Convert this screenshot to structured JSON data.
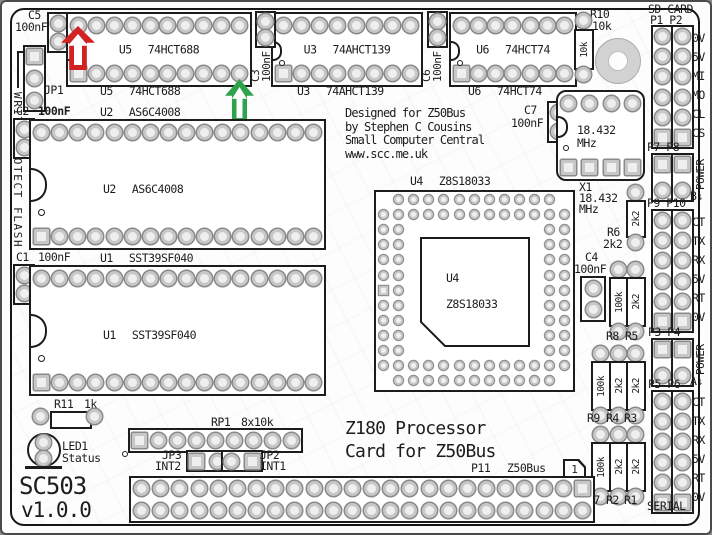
{
  "board": {
    "name": "SC503",
    "version": "v1.0.0",
    "title_line1": "Z180 Processor",
    "title_line2": "Card for Z50Bus",
    "credits": [
      "Designed for Z50Bus",
      "by Stephen C Cousins",
      "Small Computer Central",
      "www.scc.me.uk"
    ],
    "write_protect": "WRITE PROTECT FLASH"
  },
  "ics": {
    "u5": {
      "ref": "U5",
      "part": "74HCT688"
    },
    "u3": {
      "ref": "U3",
      "part": "74AHCT139"
    },
    "u6": {
      "ref": "U6",
      "part": "74HCT74"
    },
    "u2": {
      "ref": "U2",
      "part": "AS6C4008"
    },
    "u1": {
      "ref": "U1",
      "part": "SST39SF040"
    },
    "u4": {
      "ref": "U4",
      "part": "Z8S18033"
    }
  },
  "xtal": {
    "ref": "X1",
    "freq": "18.432",
    "unit": "MHz"
  },
  "caps": {
    "c1": {
      "ref": "C1",
      "value": "100nF"
    },
    "c2": {
      "ref": "C2",
      "value": "100nF"
    },
    "c3": {
      "ref": "C3",
      "value": "100nF"
    },
    "c4": {
      "ref": "C4",
      "value": "100nF"
    },
    "c5": {
      "ref": "C5",
      "value": "100nF"
    },
    "c6": {
      "ref": "C6",
      "value": "100nF"
    },
    "c7": {
      "ref": "C7",
      "value": "100nF"
    }
  },
  "res": {
    "r1": {
      "ref": "R1",
      "value": "2k2"
    },
    "r2": {
      "ref": "R2",
      "value": "2k2"
    },
    "r3": {
      "ref": "R3",
      "value": "2k2"
    },
    "r4": {
      "ref": "R4",
      "value": "2k2"
    },
    "r5": {
      "ref": "R5",
      "value": "2k2"
    },
    "r6": {
      "ref": "R6",
      "value": "2k2"
    },
    "r7": {
      "ref": "R7",
      "value": "100k"
    },
    "r8": {
      "ref": "R8",
      "value": "100k"
    },
    "r9": {
      "ref": "R9",
      "value": "100k"
    },
    "r10": {
      "ref": "R10",
      "value": "10k"
    },
    "r11": {
      "ref": "R11",
      "value": "1k"
    }
  },
  "rp1": {
    "ref": "RP1",
    "value": "8x10k"
  },
  "jumpers": {
    "jp1": {
      "ref": "JP1"
    },
    "jp2": {
      "ref": "JP2",
      "signal": "INT1"
    },
    "jp3": {
      "ref": "JP3",
      "signal": "INT2"
    }
  },
  "led": {
    "ref": "LED1",
    "label": "Status"
  },
  "conn": {
    "sd": {
      "title": "SD CARD",
      "ports": "P1 P2",
      "pins": [
        "0V",
        "5V",
        "MI",
        "MO",
        "CL",
        "CS"
      ]
    },
    "p7p8": {
      "ports": "P7 P8",
      "power": "POWER",
      "tag": "B",
      "arrow": "↓"
    },
    "p9p10": {
      "ports": "P9 P10",
      "pins": [
        "CT",
        "TX",
        "RX",
        "5V",
        "RT",
        "0V"
      ]
    },
    "p3p4": {
      "ports": "P3 P4",
      "power": "POWER",
      "tag": "A",
      "arrow": "↓"
    },
    "p5p6": {
      "ports": "P5 P6",
      "pins": [
        "CT",
        "TX",
        "RX",
        "5V",
        "RT",
        "0V"
      ]
    },
    "serial": "SERIAL",
    "z50": {
      "ref": "P11",
      "name": "Z50Bus",
      "pin1": "1"
    }
  },
  "colors": {
    "silk": "#1c1c1c",
    "red_arrow": "#d32222",
    "green_arrow": "#2fa24c"
  }
}
